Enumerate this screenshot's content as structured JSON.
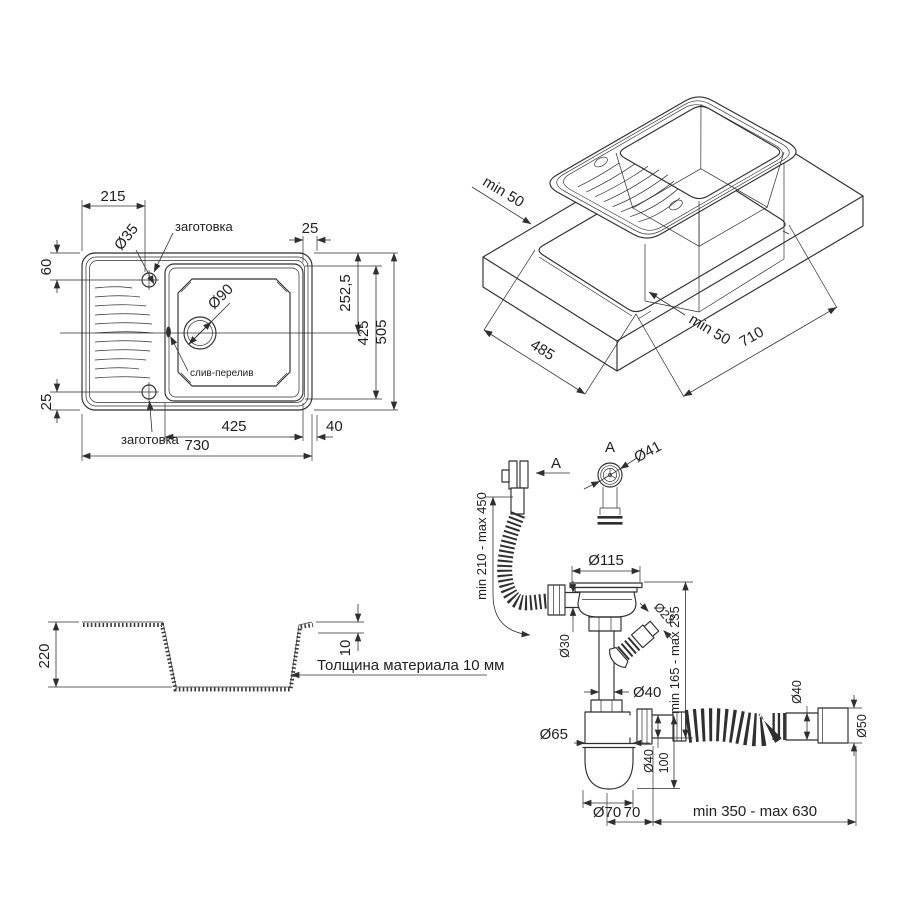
{
  "drawing_title": "Sink installation technical drawing",
  "top_view": {
    "dim_215": "215",
    "dim_25_top": "25",
    "dim_60": "60",
    "dim_25_left": "25",
    "hole_dia": "Ø35",
    "hole_note_top": "заготовка",
    "hole_note_bottom": "заготовка",
    "drain_dia": "Ø90",
    "overflow_note": "слив-перелив",
    "dim_252_5": "252,5",
    "dim_425_side": "425",
    "dim_505": "505",
    "dim_425_bottom": "425",
    "dim_40": "40",
    "dim_730": "730"
  },
  "iso_view": {
    "dim_min50_left": "min 50",
    "dim_485": "485",
    "dim_min50_mid": "min 50",
    "dim_710": "710"
  },
  "section_view": {
    "dim_220": "220",
    "dim_10": "10",
    "note": "Толщина материала 10 мм"
  },
  "siphon_view": {
    "label_section_a": "A",
    "label_detail_a": "A",
    "dia_41": "Ø41",
    "dim_overflow_hose": "min 210 - max 450",
    "dia_115": "Ø115",
    "dia_30": "Ø30",
    "dia_23": "Ø23",
    "dim_height": "min 165 - max 235",
    "dia_40_pipe": "Ø40",
    "dia_65": "Ø65",
    "dia_40_outlet": "Ø40",
    "dim_100": "100",
    "dia_70": "Ø70",
    "dim_70": "70",
    "dim_outlet_hose": "min 350 - max 630",
    "dia_40_hose": "Ø40",
    "dia_50": "Ø50"
  },
  "colors": {
    "line": "#2f2f2f",
    "background": "#ffffff"
  }
}
